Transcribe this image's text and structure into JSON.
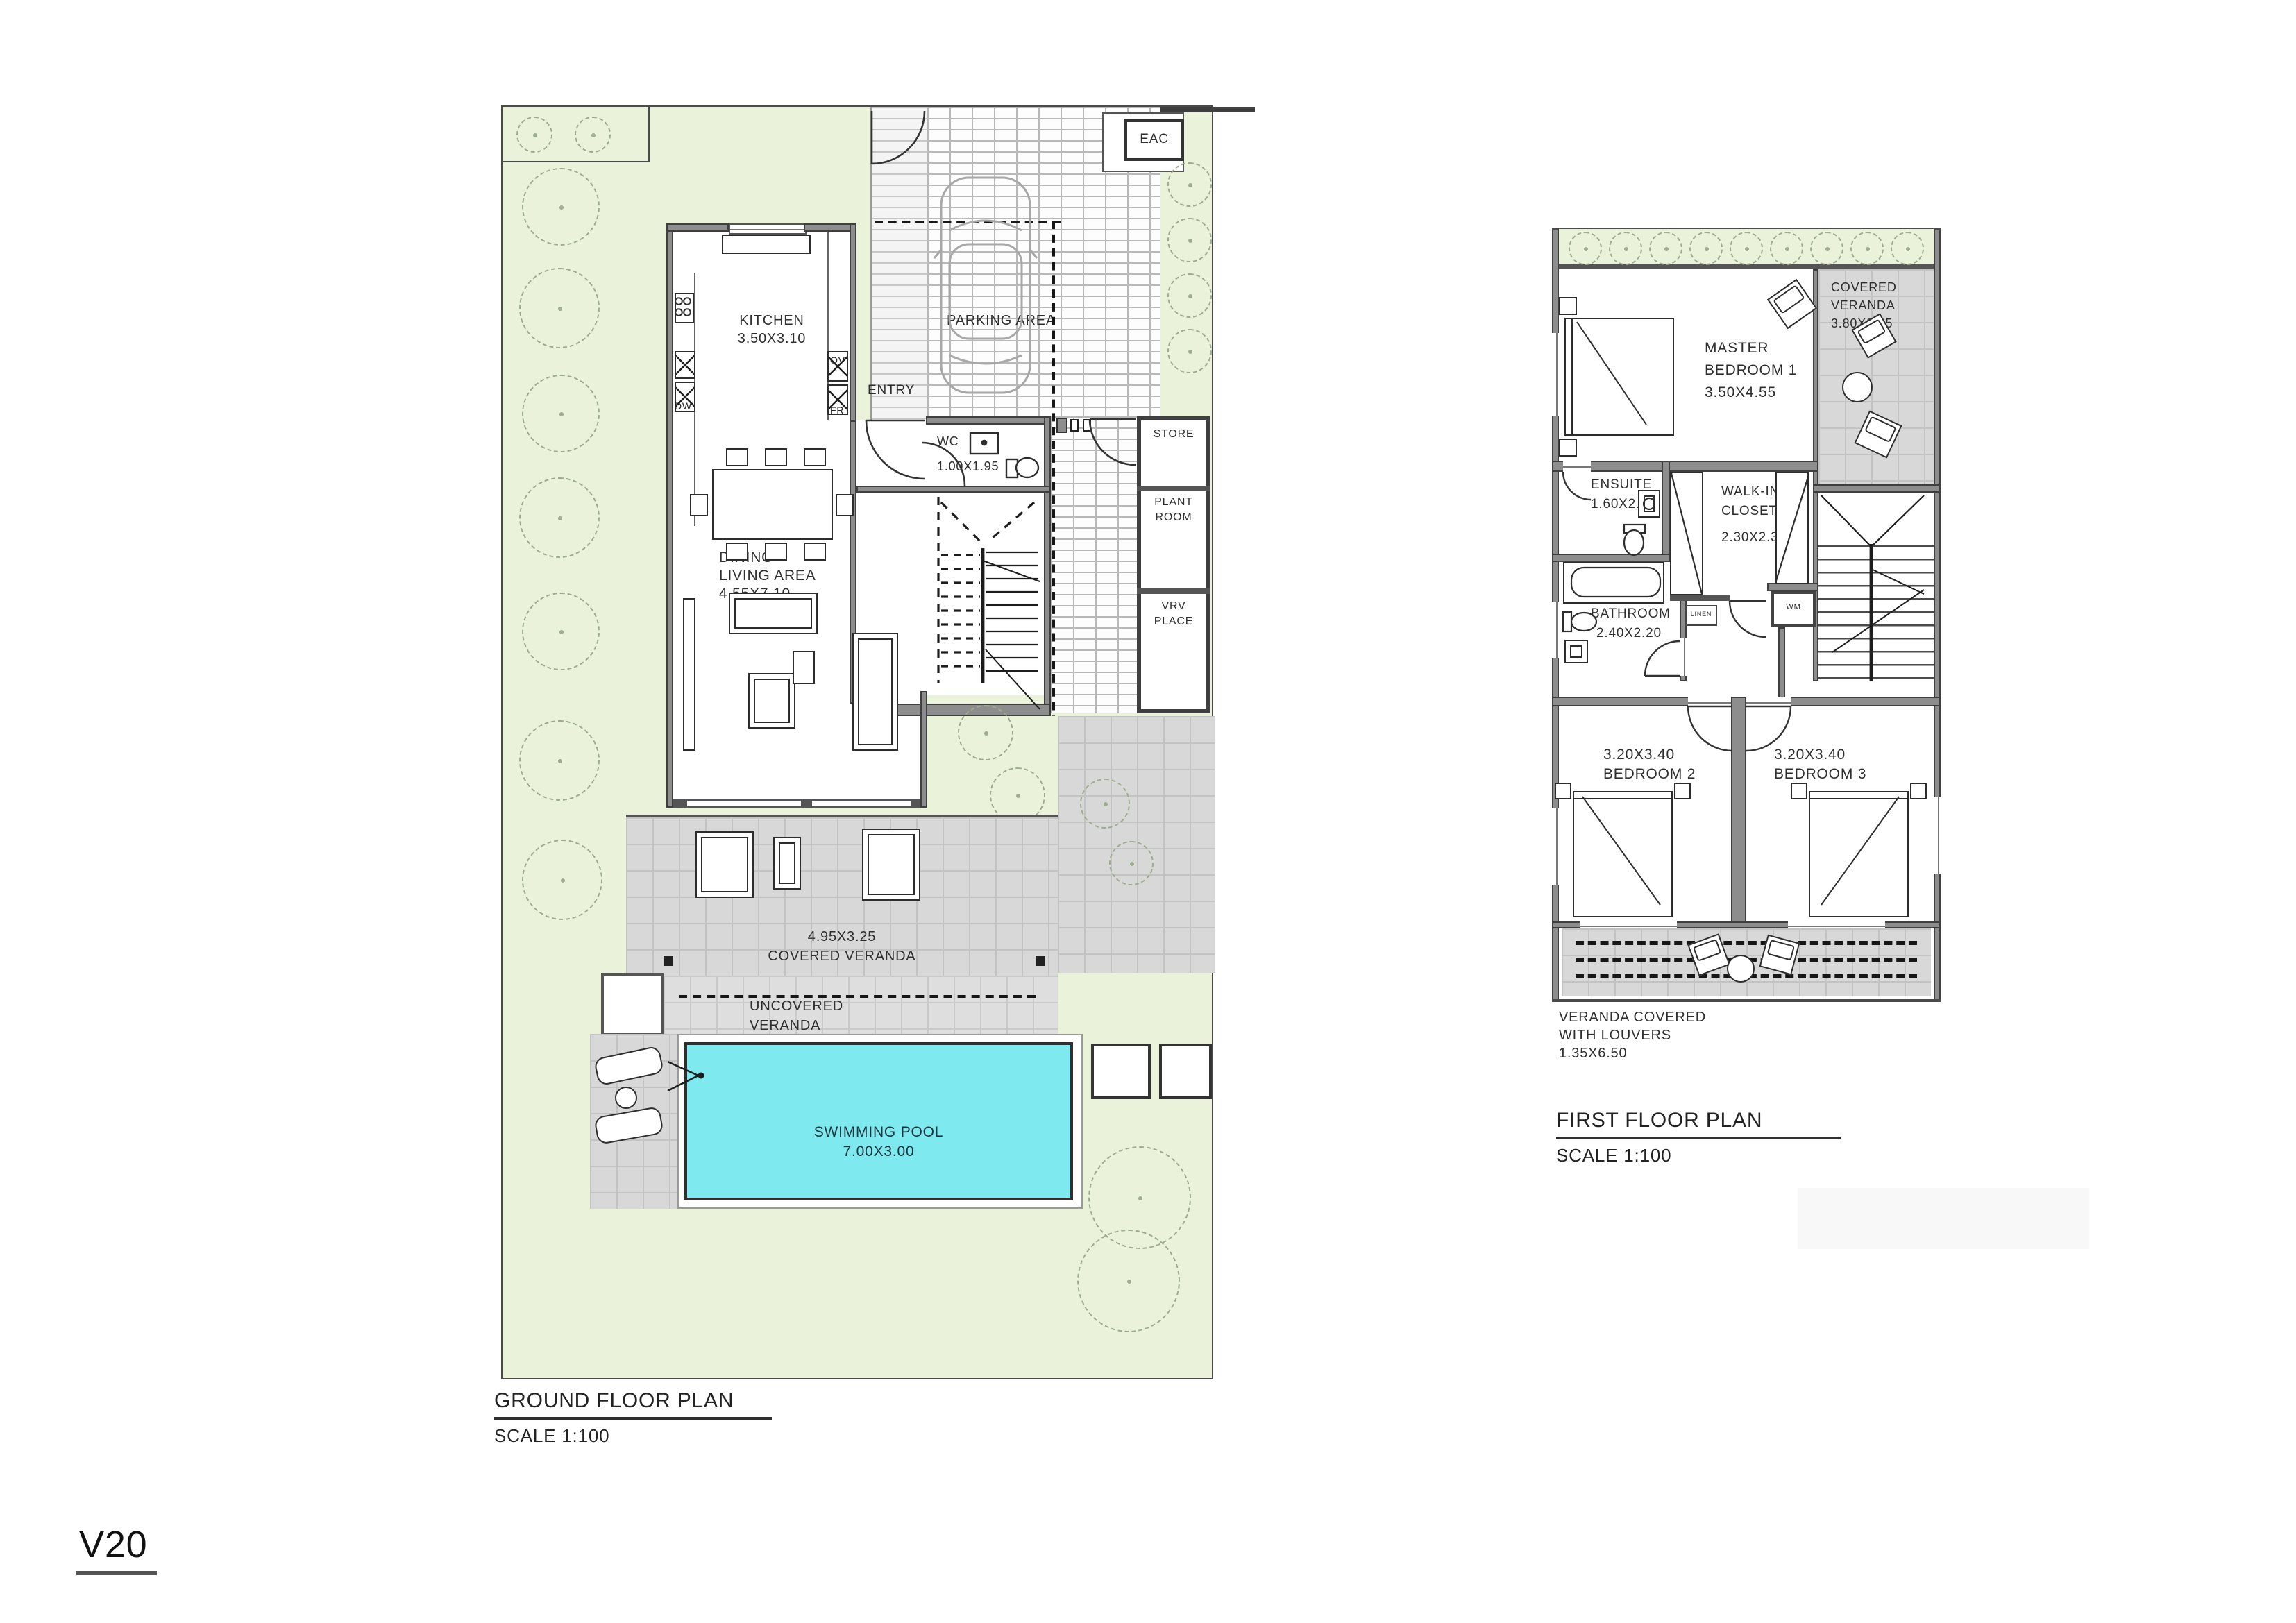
{
  "sheet": {
    "code": "V20"
  },
  "colors": {
    "garden": "#eaf3da",
    "tile": "#d8d8d8",
    "pool": "#7fe9f0",
    "wall": "#8d8d8d",
    "accent_dark": "#3f3f3f"
  },
  "ground_floor": {
    "title": "GROUND FLOOR PLAN",
    "scale": "SCALE 1:100",
    "labels": {
      "kitchen_name": "KITCHEN",
      "kitchen_dims": "3.50X3.10",
      "dining_l1": "DINING",
      "dining_l2": "LIVING AREA",
      "dining_l3": "4.55X7.10",
      "wc_name": "WC",
      "wc_dims": "1.00X1.95",
      "entry": "ENTRY",
      "parking": "PARKING AREA",
      "eac": "EAC",
      "store": "STORE",
      "plant_l1": "PLANT",
      "plant_l2": "ROOM",
      "vrv_l1": "VRV",
      "vrv_l2": "PLACE",
      "dw": "DW",
      "ov": "OV",
      "fr": "FR",
      "covered_veranda_dims": "4.95X3.25",
      "covered_veranda_name": "COVERED VERANDA",
      "uncovered_l1": "UNCOVERED",
      "uncovered_l2": "VERANDA",
      "pool_l1": "SWIMMING POOL",
      "pool_l2": "7.00X3.00"
    }
  },
  "first_floor": {
    "title": "FIRST FLOOR PLAN",
    "scale": "SCALE 1:100",
    "labels": {
      "master_l1": "MASTER",
      "master_l2": "BEDROOM 1",
      "master_l3": "3.50X4.55",
      "veranda_l1": "COVERED",
      "veranda_l2": "VERANDA",
      "veranda_l3": "3.80X2.05",
      "ensuite_l1": "ENSUITE",
      "ensuite_l2": "1.60X2.20",
      "walkin_l1": "WALK-IN",
      "walkin_l2": "CLOSET",
      "walkin_l3": "2.30X2.30",
      "bath_l1": "BATHROOM",
      "bath_l2": "2.40X2.20",
      "wm": "WM",
      "linen": "LINEN",
      "bed2_dims": "3.20X3.40",
      "bed2_name": "BEDROOM 2",
      "bed3_dims": "3.20X3.40",
      "bed3_name": "BEDROOM 3",
      "louver_l1": "VERANDA COVERED",
      "louver_l2": "WITH LOUVERS",
      "louver_l3": "1.35X6.50"
    }
  }
}
